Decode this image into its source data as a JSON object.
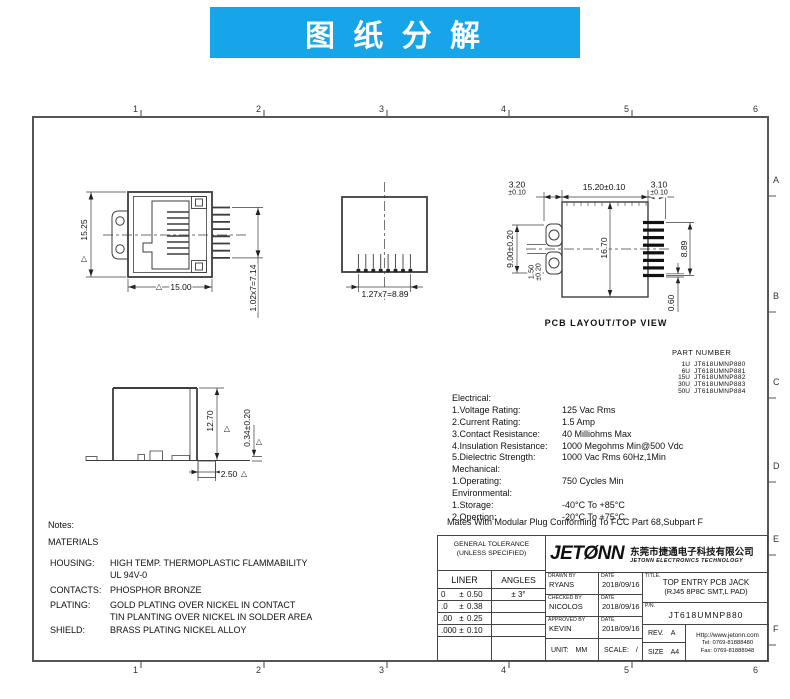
{
  "banner": {
    "title": "图 纸 分 解"
  },
  "frame": {
    "top_labels": [
      "1",
      "2",
      "3",
      "4",
      "5",
      "6"
    ],
    "side_labels": [
      "A",
      "B",
      "C",
      "D",
      "E",
      "F"
    ]
  },
  "front_view": {
    "dim_height": "15.25",
    "dim_width": "15.00",
    "dim_pin_span": "1.02x7=7.14"
  },
  "top_view": {
    "dim_pin_span": "1.27x7=8.89"
  },
  "pcb_view": {
    "label": "PCB  LAYOUT/TOP  VIEW",
    "dim_left_pad": "3.20",
    "dim_left_pad_tol": "±0.10",
    "dim_body_width": "15.20±0.10",
    "dim_right_pad": "3.10",
    "dim_right_pad_tol": "±0.10",
    "dim_hole_span": "9.00±0.20",
    "dim_slot": "1.50",
    "dim_slot_tol": "±0.20",
    "dim_body_height": "16.70",
    "dim_pad_span": "8.89",
    "dim_pad_width": "0.60"
  },
  "side_view": {
    "dim_height": "12.70",
    "dim_standoff": "0.34±0.20",
    "dim_foot": "2.50"
  },
  "part_number": {
    "title": "PART NUMBER",
    "rows": [
      {
        "plating": "1U",
        "pn": "JT618UMNP880"
      },
      {
        "plating": "6U",
        "pn": "JT618UMNP881"
      },
      {
        "plating": "15U",
        "pn": "JT618UMNP882"
      },
      {
        "plating": "30U",
        "pn": "JT618UMNP883"
      },
      {
        "plating": "50U",
        "pn": "JT618UMNP884"
      }
    ]
  },
  "specs": {
    "electrical_title": "Electrical:",
    "electrical": [
      {
        "label": "1.Voltage Rating:",
        "value": "125 Vac Rms"
      },
      {
        "label": "2.Current Rating:",
        "value": "1.5 Amp"
      },
      {
        "label": "3.Contact Resistance:",
        "value": "40 Milliohms Max"
      },
      {
        "label": "4.Insulation Resistance:",
        "value": "1000 Megohms Min@500 Vdc"
      },
      {
        "label": "5.Dielectric Strength:",
        "value": "1000 Vac Rms 60Hz,1Min"
      }
    ],
    "mechanical_title": "Mechanical:",
    "mechanical": [
      {
        "label": "1.Operating:",
        "value": "750 Cycles Min"
      }
    ],
    "environmental_title": "Environmental:",
    "environmental": [
      {
        "label": "1.Storage:",
        "value": "-40°C To +85°C"
      },
      {
        "label": "2.Opertion:",
        "value": "-20°C To +75°C"
      }
    ],
    "footer": "Mates With Modular Plug Conforming To FCC Part 68,Subpart F"
  },
  "notes": {
    "title": "Notes:",
    "subtitle": "MATERIALS",
    "rows": [
      {
        "label": "HOUSING:",
        "value": "HIGH TEMP. THERMOPLASTIC FLAMMABILITY",
        "value2": "UL 94V-0"
      },
      {
        "label": "CONTACTS:",
        "value": "PHOSPHOR BRONZE",
        "value2": ""
      },
      {
        "label": "PLATING:",
        "value": "GOLD PLATING OVER NICKEL IN CONTACT",
        "value2": "TIN PLANTING OVER NICKEL IN SOLDER AREA"
      },
      {
        "label": "SHIELD:",
        "value": "BRASS PLATING NICKEL ALLOY",
        "value2": ""
      }
    ]
  },
  "title_block": {
    "tolerance": {
      "title_line1": "GENERAL TOLERANCE",
      "title_line2": "(UNLESS SPECIFIED)",
      "col_liner": "LINER",
      "col_angles": "ANGLES",
      "rows": [
        {
          "base": "0",
          "pm": "±",
          "tol": "0.50",
          "angle": "±  3°"
        },
        {
          "base": ".0",
          "pm": "±",
          "tol": "0.38",
          "angle": ""
        },
        {
          "base": ".00",
          "pm": "±",
          "tol": "0.25",
          "angle": ""
        },
        {
          "base": ".000",
          "pm": "±",
          "tol": "0.10",
          "angle": ""
        }
      ]
    },
    "signoff": [
      {
        "caption": "DRAWN BY",
        "name": "RYANS",
        "date_caption": "DATE",
        "date": "2018/09/16"
      },
      {
        "caption": "CHECKED BY",
        "name": "NICOLOS",
        "date_caption": "DATE",
        "date": "2018/09/16"
      },
      {
        "caption": "APPROVED BY",
        "name": "KEVIN",
        "date_caption": "DATE",
        "date": "2018/09/16"
      }
    ],
    "unit_caption": "UNIT:",
    "unit": "MM",
    "scale_caption": "SCALE:",
    "scale": "/",
    "logo_left": "JET",
    "logo_o": "Ø",
    "logo_right": "NN",
    "company_cn": "东莞市捷通电子科技有限公司",
    "company_en": "JETONN ELECTRONICS TECHNOLOGY",
    "title_caption": "TITLE.",
    "title_line1": "TOP ENTRY PCB JACK",
    "title_line2": "(RJ45 8P8C SMT,L PAD)",
    "pn_caption": "P/N.",
    "pn": "JT618UMNP880",
    "rev_caption": "REV.",
    "rev": "A",
    "size_caption": "SIZE",
    "size": "A4",
    "website": "Http://www.jetonn.com",
    "tel": "Tel:  0769-81888480",
    "fax": "Fax: 0769-81888948"
  }
}
